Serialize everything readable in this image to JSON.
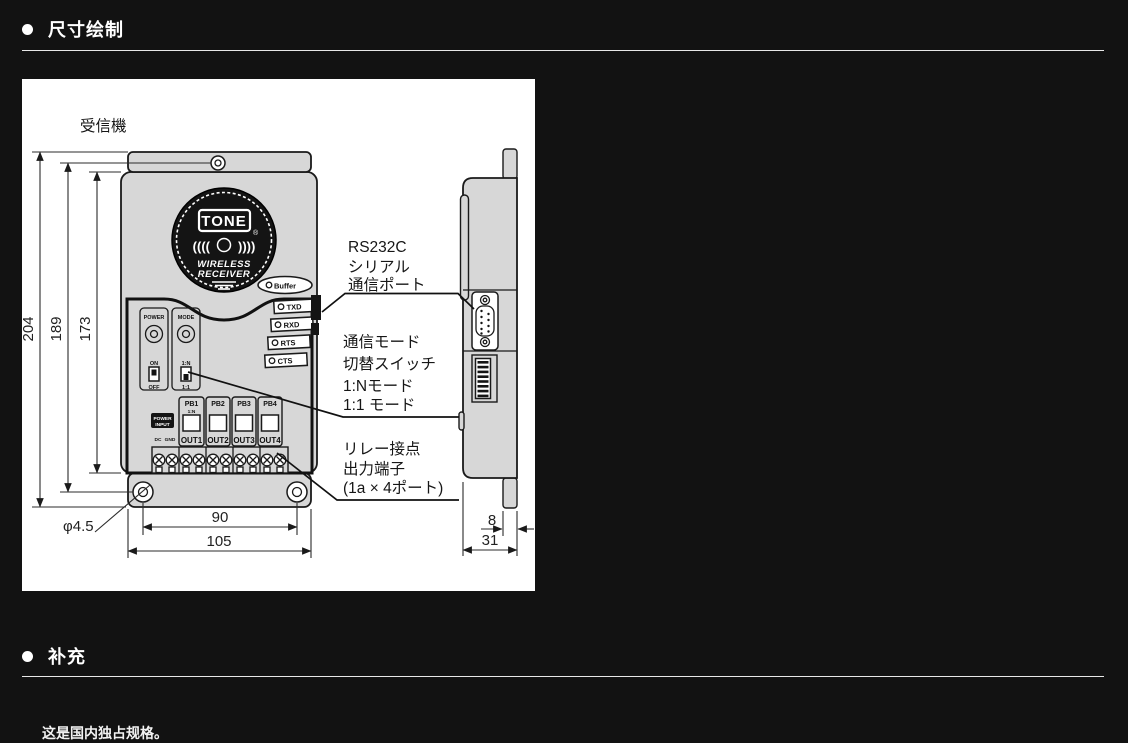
{
  "page": {
    "background": "#121212"
  },
  "sections": {
    "dimensions": {
      "title": "尺寸绘制"
    },
    "supplement": {
      "title": "补充",
      "note": "这是国内独占规格。"
    }
  },
  "drawing": {
    "device_label": "受信機",
    "logo": {
      "brand": "TONE",
      "reg": "®",
      "sub1": "WIRELESS",
      "sub2": "RECEIVER"
    },
    "leds": {
      "buffer": "Buffer",
      "txd": "TXD",
      "rxd": "RXD",
      "rts": "RTS",
      "cts": "CTS"
    },
    "controls": {
      "power": "POWER",
      "mode": "MODE",
      "on": "ON",
      "off": "OFF",
      "mode_n": "1:N",
      "mode_one": "1:1",
      "power_input1": "POWER",
      "power_input2": "INPUT",
      "dc": "DC",
      "gnd": "GND"
    },
    "ports": {
      "pb": [
        "PB1",
        "PB2",
        "PB3",
        "PB4"
      ],
      "pb1_mode": "1:N",
      "out": [
        "OUT1",
        "OUT2",
        "OUT3",
        "OUT4"
      ]
    },
    "dims": {
      "total_height": "204",
      "mount_height": "189",
      "body_height": "173",
      "mount_width": "90",
      "total_width": "105",
      "hole": "φ4.5",
      "depth_plate": "8",
      "depth_total": "31"
    },
    "annotations": {
      "rs232c": [
        "RS232C",
        "シリアル",
        "通信ポート"
      ],
      "mode_switch": [
        "通信モード",
        "切替スイッチ",
        "1:Nモード",
        "1:1 モード"
      ],
      "relay": [
        "リレー接点",
        "出力端子",
        "(1a × 4ポート)"
      ]
    }
  }
}
